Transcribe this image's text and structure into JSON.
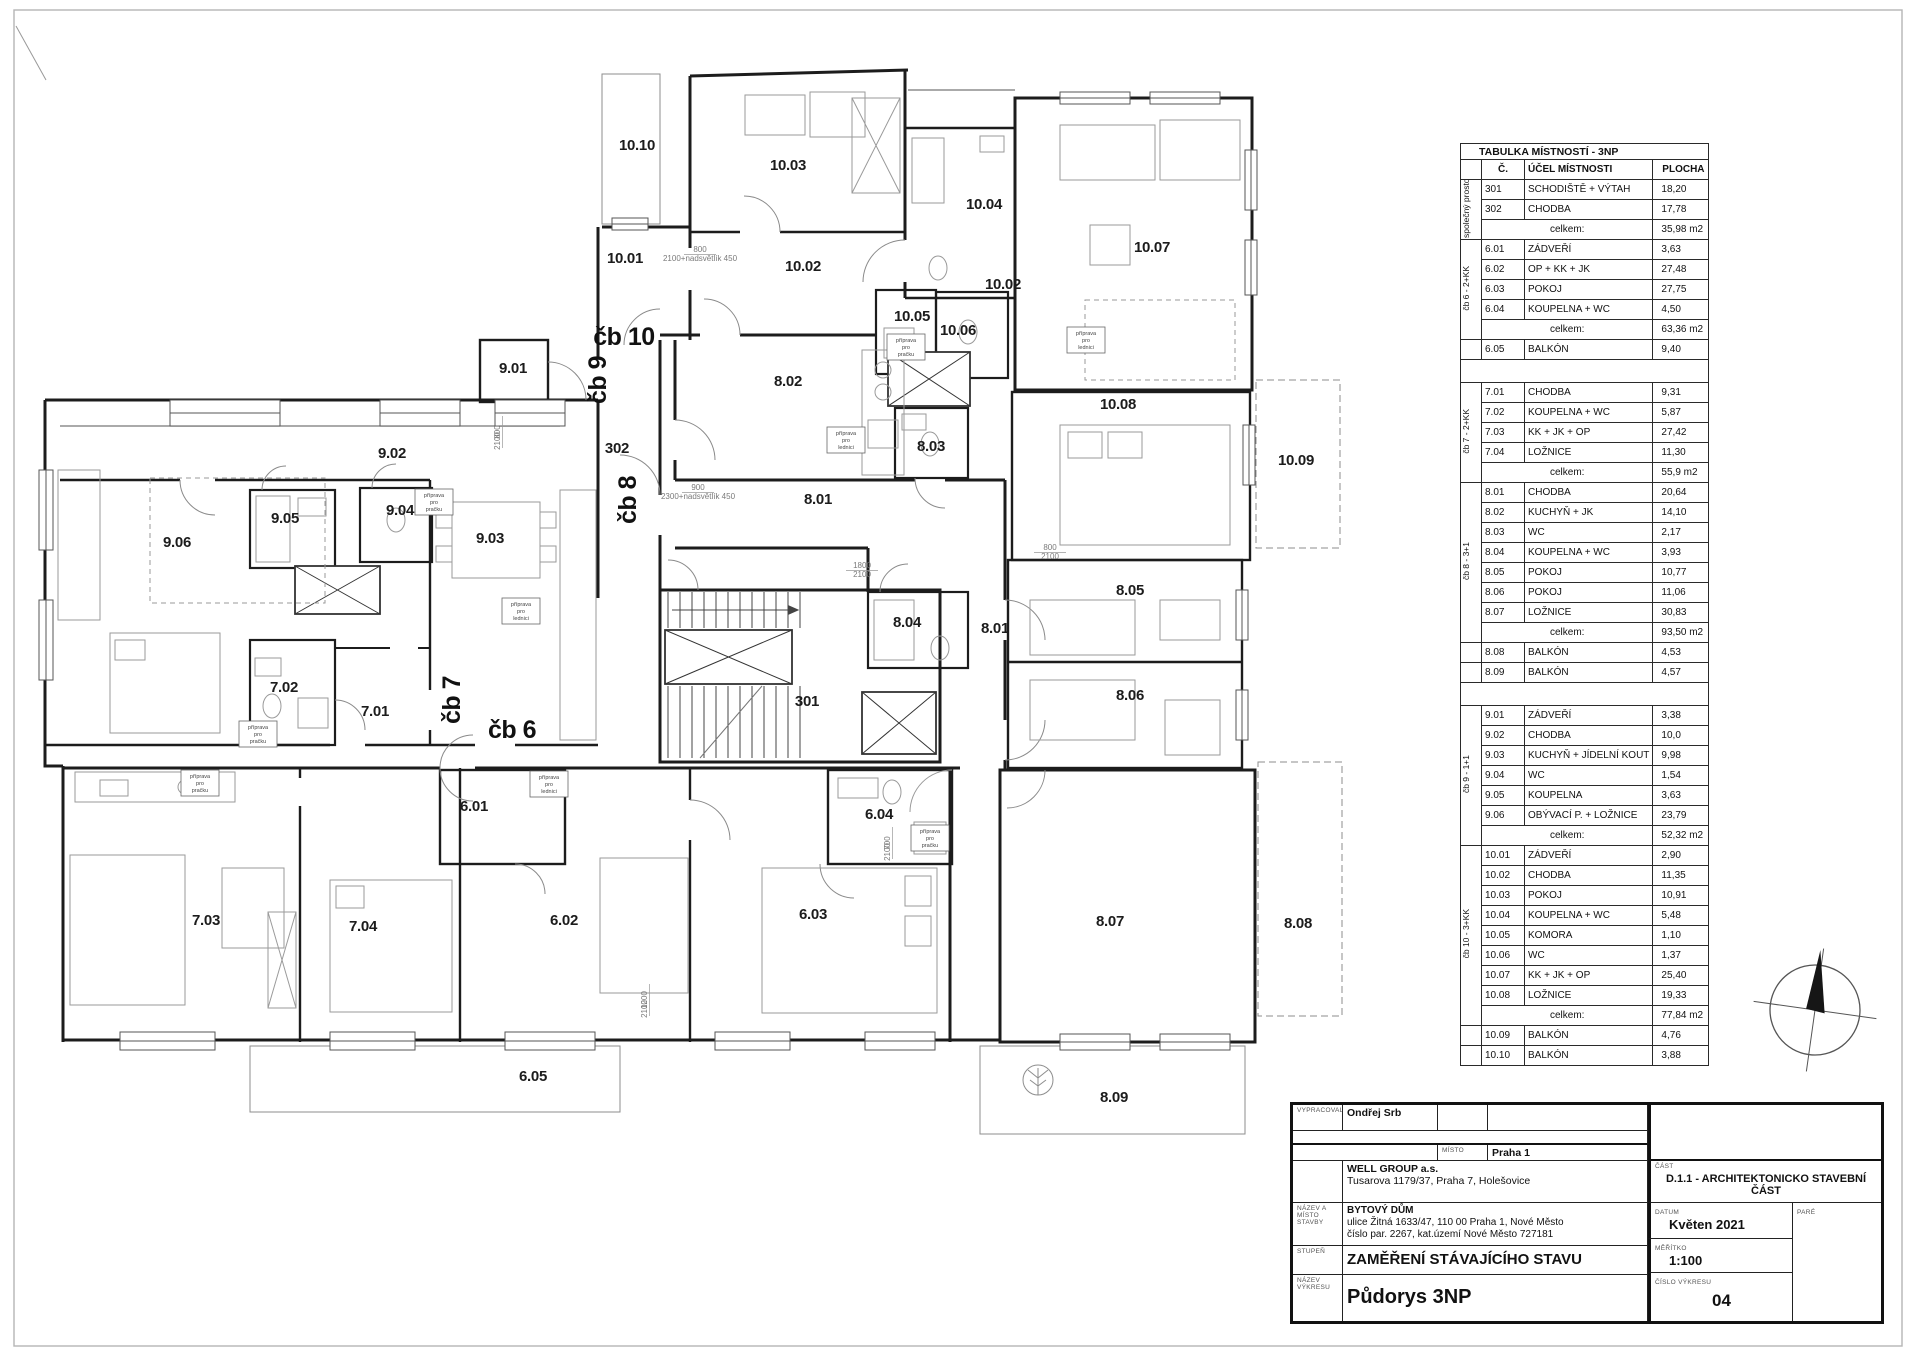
{
  "sheet": {
    "paper_color": "#ffffff",
    "line_color": "#1a1a1a"
  },
  "room_table": {
    "title": "TABULKA MÍSTNOSTÍ - 3NP",
    "columns": {
      "num": "Č.",
      "purpose": "ÚČEL MÍSTNOSTI",
      "area": "PLOCHA"
    },
    "total_label": "celkem:",
    "groups": [
      {
        "label": "společný prostor",
        "rows": [
          [
            "301",
            "SCHODIŠTĚ + VÝTAH",
            "18,20"
          ],
          [
            "302",
            "CHODBA",
            "17,78"
          ]
        ],
        "total": "35,98 m2",
        "extras": [],
        "spacer_after": false
      },
      {
        "label": "čb 6 - 2+KK",
        "rows": [
          [
            "6.01",
            "ZÁDVEŘÍ",
            "3,63"
          ],
          [
            "6.02",
            "OP + KK + JK",
            "27,48"
          ],
          [
            "6.03",
            "POKOJ",
            "27,75"
          ],
          [
            "6.04",
            "KOUPELNA + WC",
            "4,50"
          ]
        ],
        "total": "63,36 m2",
        "extras": [
          [
            "6.05",
            "BALKÓN",
            "9,40"
          ]
        ],
        "spacer_after": true
      },
      {
        "label": "čb 7 - 2+KK",
        "rows": [
          [
            "7.01",
            "CHODBA",
            "9,31"
          ],
          [
            "7.02",
            "KOUPELNA + WC",
            "5,87"
          ],
          [
            "7.03",
            "KK + JK + OP",
            "27,42"
          ],
          [
            "7.04",
            "LOŽNICE",
            "11,30"
          ]
        ],
        "total": "55,9 m2",
        "extras": [],
        "spacer_after": false
      },
      {
        "label": "čb 8 - 3+1",
        "rows": [
          [
            "8.01",
            "CHODBA",
            "20,64"
          ],
          [
            "8.02",
            "KUCHYŇ + JK",
            "14,10"
          ],
          [
            "8.03",
            "WC",
            "2,17"
          ],
          [
            "8.04",
            "KOUPELNA + WC",
            "3,93"
          ],
          [
            "8.05",
            "POKOJ",
            "10,77"
          ],
          [
            "8.06",
            "POKOJ",
            "11,06"
          ],
          [
            "8.07",
            "LOŽNICE",
            "30,83"
          ]
        ],
        "total": "93,50 m2",
        "extras": [
          [
            "8.08",
            "BALKÓN",
            "4,53"
          ],
          [
            "8.09",
            "BALKÓN",
            "4,57"
          ]
        ],
        "spacer_after": true
      },
      {
        "label": "čb 9 - 1+1",
        "rows": [
          [
            "9.01",
            "ZÁDVEŘÍ",
            "3,38"
          ],
          [
            "9.02",
            "CHODBA",
            "10,0"
          ],
          [
            "9.03",
            "KUCHYŇ + JÍDELNÍ KOUT",
            "9,98"
          ],
          [
            "9.04",
            "WC",
            "1,54"
          ],
          [
            "9.05",
            "KOUPELNA",
            "3,63"
          ],
          [
            "9.06",
            "OBÝVACÍ P. + LOŽNICE",
            "23,79"
          ]
        ],
        "total": "52,32 m2",
        "extras": [],
        "spacer_after": false
      },
      {
        "label": "čb 10 - 3+KK",
        "rows": [
          [
            "10.01",
            "ZÁDVEŘÍ",
            "2,90"
          ],
          [
            "10.02",
            "CHODBA",
            "11,35"
          ],
          [
            "10.03",
            "POKOJ",
            "10,91"
          ],
          [
            "10.04",
            "KOUPELNA + WC",
            "5,48"
          ],
          [
            "10.05",
            "KOMORA",
            "1,10"
          ],
          [
            "10.06",
            "WC",
            "1,37"
          ],
          [
            "10.07",
            "KK + JK + OP",
            "25,40"
          ],
          [
            "10.08",
            "LOŽNICE",
            "19,33"
          ]
        ],
        "total": "77,84 m2",
        "extras": [
          [
            "10.09",
            "BALKÓN",
            "4,76"
          ],
          [
            "10.10",
            "BALKÓN",
            "3,88"
          ]
        ],
        "spacer_after": false
      }
    ]
  },
  "title_block": {
    "vypracoval_label": "VYPRACOVAL",
    "vypracoval": "Ondřej Srb",
    "misto_label": "MÍSTO",
    "misto": "Praha 1",
    "investor_name": "WELL GROUP a.s.",
    "investor_address": "Tusarova 1179/37, Praha 7, Holešovice",
    "nazev_stavby_label": "NÁZEV A MÍSTO STAVBY",
    "building_name": "BYTOVÝ DŮM",
    "building_address1": "ulice Žitná 1633/47, 110 00  Praha 1, Nové Město",
    "building_address2": "číslo par. 2267, kat.území Nové Město 727181",
    "stupen_label": "STUPEŇ",
    "stupen": "ZAMĚŘENÍ STÁVAJÍCÍHO STAVU",
    "nazev_vykresu_label": "NÁZEV VÝKRESU",
    "drawing_title": "Půdorys 3NP",
    "cast_label": "ČÁST",
    "cast": "D.1.1 - ARCHITEKTONICKO STAVEBNÍ ČÁST",
    "datum_label": "DATUM",
    "datum": "Květen 2021",
    "meritko_label": "MĚŘÍTKO",
    "meritko": "1:100",
    "cislo_label": "ČÍSLO  VÝKRESU",
    "cislo": "04",
    "pare_label": "PARÉ"
  },
  "plan": {
    "room_labels": [
      {
        "t": "10.10",
        "x": 637,
        "y": 150
      },
      {
        "t": "10.03",
        "x": 788,
        "y": 170
      },
      {
        "t": "10.04",
        "x": 984,
        "y": 209
      },
      {
        "t": "10.07",
        "x": 1152,
        "y": 252
      },
      {
        "t": "10.01",
        "x": 625,
        "y": 263
      },
      {
        "t": "10.02",
        "x": 803,
        "y": 271
      },
      {
        "t": "10.02",
        "x": 1003,
        "y": 289
      },
      {
        "t": "10.05",
        "x": 912,
        "y": 321
      },
      {
        "t": "10.06",
        "x": 958,
        "y": 335
      },
      {
        "t": "10.08",
        "x": 1118,
        "y": 409
      },
      {
        "t": "10.09",
        "x": 1296,
        "y": 465
      },
      {
        "t": "9.01",
        "x": 513,
        "y": 373
      },
      {
        "t": "9.02",
        "x": 392,
        "y": 458
      },
      {
        "t": "9.04",
        "x": 400,
        "y": 515
      },
      {
        "t": "9.05",
        "x": 285,
        "y": 523
      },
      {
        "t": "9.03",
        "x": 490,
        "y": 543
      },
      {
        "t": "9.06",
        "x": 177,
        "y": 547
      },
      {
        "t": "302",
        "x": 617,
        "y": 453
      },
      {
        "t": "8.02",
        "x": 788,
        "y": 386
      },
      {
        "t": "8.03",
        "x": 931,
        "y": 451
      },
      {
        "t": "8.01",
        "x": 818,
        "y": 504
      },
      {
        "t": "8.05",
        "x": 1130,
        "y": 595
      },
      {
        "t": "8.04",
        "x": 907,
        "y": 627
      },
      {
        "t": "8.01",
        "x": 995,
        "y": 633
      },
      {
        "t": "8.06",
        "x": 1130,
        "y": 700
      },
      {
        "t": "301",
        "x": 807,
        "y": 706
      },
      {
        "t": "7.02",
        "x": 284,
        "y": 692
      },
      {
        "t": "7.01",
        "x": 375,
        "y": 716
      },
      {
        "t": "6.01",
        "x": 474,
        "y": 811
      },
      {
        "t": "6.04",
        "x": 879,
        "y": 819
      },
      {
        "t": "7.03",
        "x": 206,
        "y": 925
      },
      {
        "t": "7.04",
        "x": 363,
        "y": 931
      },
      {
        "t": "6.02",
        "x": 564,
        "y": 925
      },
      {
        "t": "6.03",
        "x": 813,
        "y": 919
      },
      {
        "t": "8.07",
        "x": 1110,
        "y": 926
      },
      {
        "t": "8.08",
        "x": 1298,
        "y": 928
      },
      {
        "t": "6.05",
        "x": 533,
        "y": 1081
      },
      {
        "t": "8.09",
        "x": 1114,
        "y": 1102
      }
    ],
    "unit_labels": [
      {
        "t": "čb 10",
        "x": 624,
        "y": 345,
        "r": 0
      },
      {
        "t": "čb 9",
        "x": 606,
        "y": 380,
        "r": -90
      },
      {
        "t": "čb 8",
        "x": 636,
        "y": 500,
        "r": -90
      },
      {
        "t": "čb 7",
        "x": 460,
        "y": 700,
        "r": -90
      },
      {
        "t": "čb 6",
        "x": 512,
        "y": 738,
        "r": 0
      }
    ],
    "prep_boxes": [
      {
        "x": 434,
        "y": 502,
        "lines": [
          "příprava",
          "pro",
          "pračku"
        ]
      },
      {
        "x": 258,
        "y": 734,
        "lines": [
          "příprava",
          "pro",
          "pračku"
        ]
      },
      {
        "x": 846,
        "y": 440,
        "lines": [
          "příprava",
          "pro",
          "lednici"
        ]
      },
      {
        "x": 930,
        "y": 838,
        "lines": [
          "příprava",
          "pro",
          "pračku"
        ]
      },
      {
        "x": 906,
        "y": 347,
        "lines": [
          "příprava",
          "pro",
          "pračku"
        ]
      },
      {
        "x": 200,
        "y": 783,
        "lines": [
          "příprava",
          "pro",
          "pračku"
        ]
      },
      {
        "x": 549,
        "y": 784,
        "lines": [
          "příprava",
          "pro",
          "lednici"
        ]
      },
      {
        "x": 521,
        "y": 611,
        "lines": [
          "příprava",
          "pro",
          "lednici"
        ]
      },
      {
        "x": 1086,
        "y": 340,
        "lines": [
          "příprava",
          "pro",
          "lednici"
        ]
      }
    ],
    "dim_texts": [
      {
        "x": 700,
        "y": 252,
        "r": 0,
        "t": "800",
        "t2": "2100+nadsvětlík  450"
      },
      {
        "x": 698,
        "y": 490,
        "r": 0,
        "t": "900",
        "t2": "2300+nadsvětlík  450"
      },
      {
        "x": 500,
        "y": 432,
        "r": -90,
        "t": "800",
        "t2": "2100"
      },
      {
        "x": 647,
        "y": 1000,
        "r": -90,
        "t": "1200",
        "t2": "2100"
      },
      {
        "x": 1050,
        "y": 550,
        "r": 0,
        "t": "800",
        "t2": "2100"
      },
      {
        "x": 890,
        "y": 843,
        "r": -90,
        "t": "700",
        "t2": "2100"
      },
      {
        "x": 862,
        "y": 568,
        "r": 0,
        "t": "1800",
        "t2": "2100"
      }
    ]
  }
}
